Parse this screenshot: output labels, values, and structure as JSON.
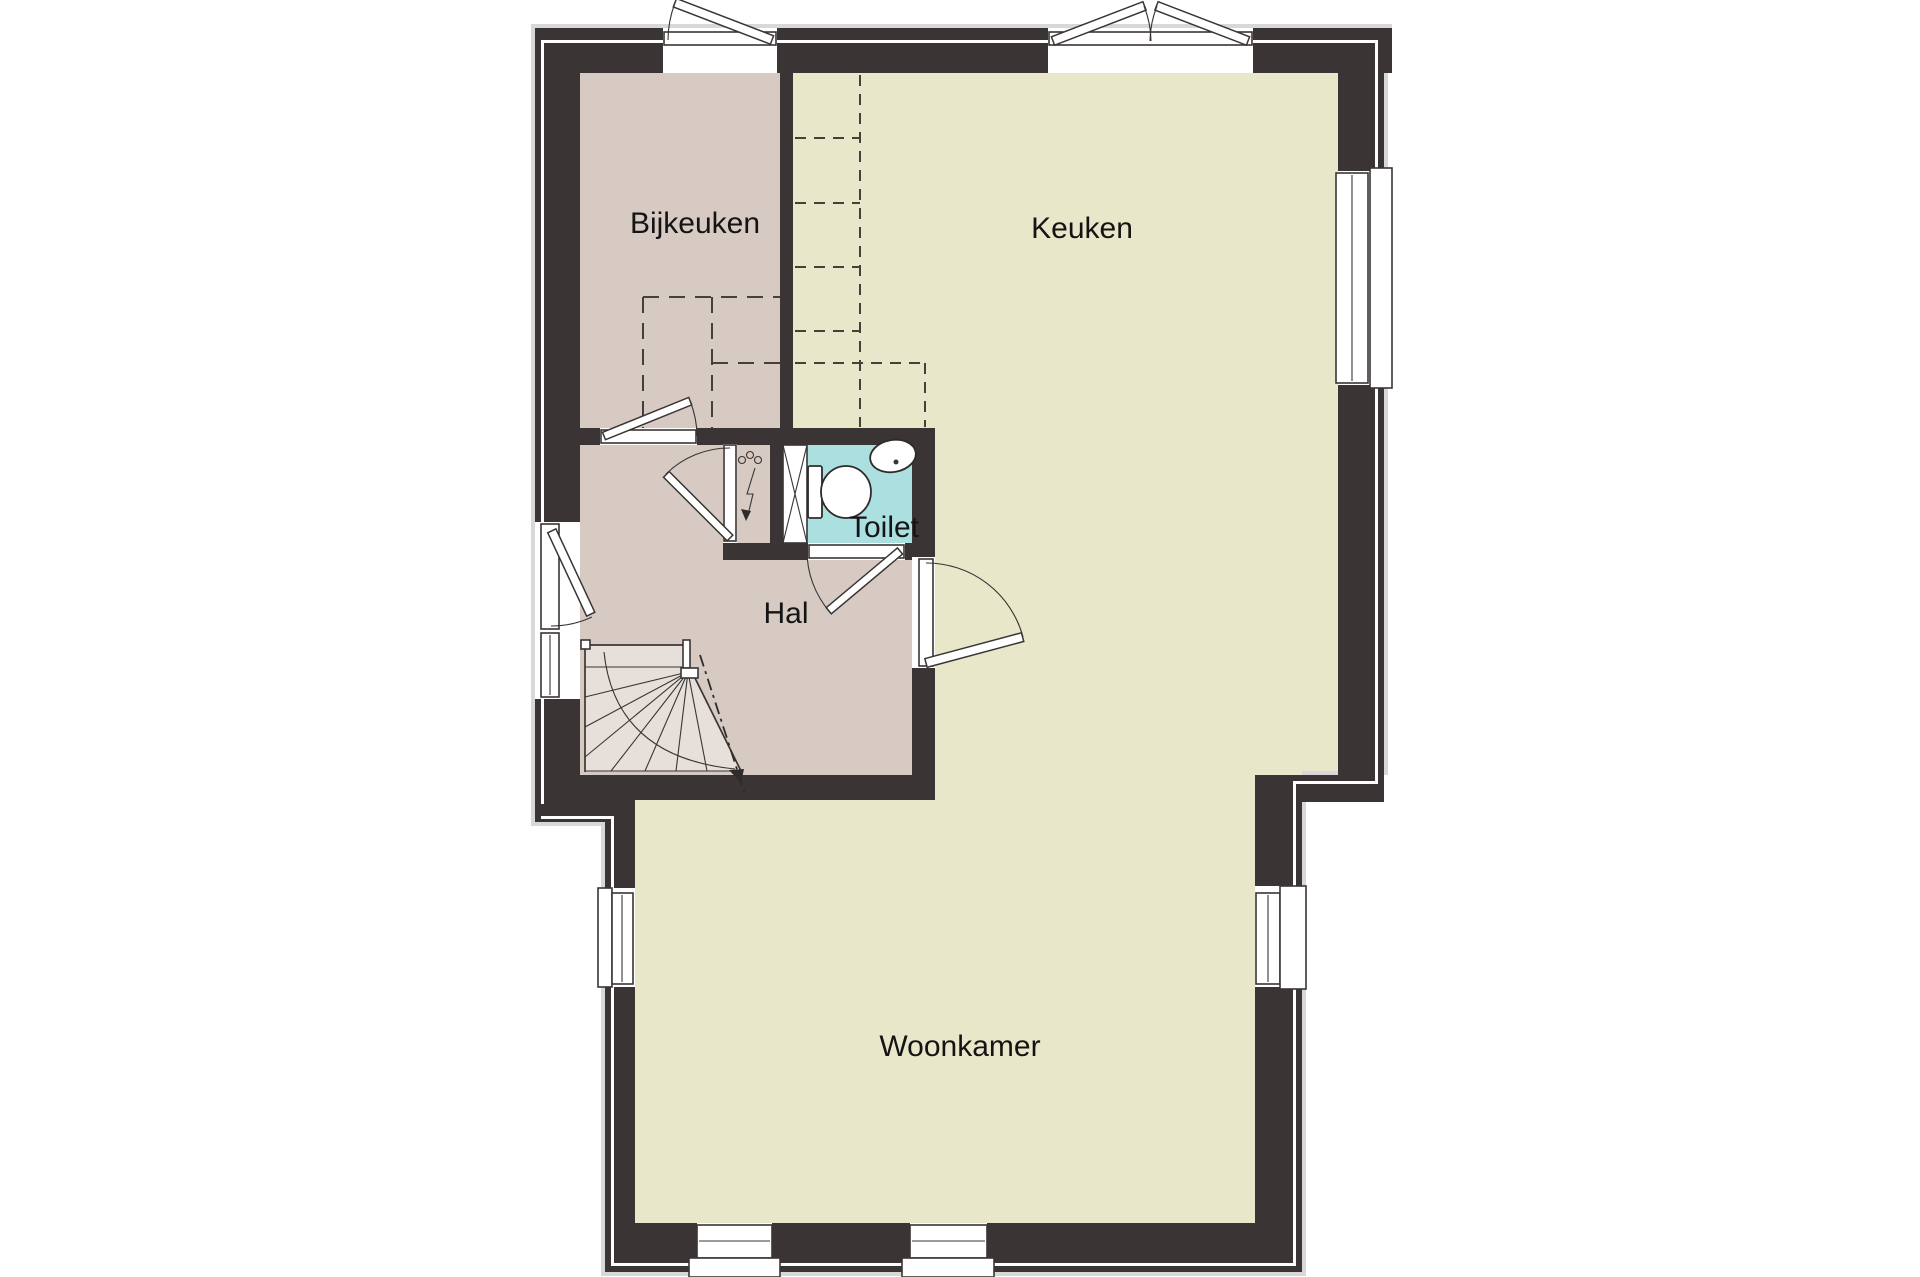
{
  "plan": {
    "rooms": {
      "bijkeuken": {
        "label": "Bijkeuken"
      },
      "keuken": {
        "label": "Keuken"
      },
      "toilet": {
        "label": "Toilet"
      },
      "hal": {
        "label": "Hal"
      },
      "woonkamer": {
        "label": "Woonkamer"
      }
    },
    "symbols": {
      "stairs": "winder-staircase-icon",
      "toilet_fixture": "toilet-bowl-icon",
      "sink": "hand-basin-icon",
      "meter_cabinet": "electric-meter-lightning-icon",
      "doors": "door-swing-arc-icon",
      "windows": "window-frame-icon"
    }
  },
  "colors": {
    "wall": "#3a3534",
    "service_floor": "#d6cac3",
    "living_floor": "#e9e7c9",
    "toilet_floor": "#abdfe0",
    "background": "#ffffff"
  }
}
